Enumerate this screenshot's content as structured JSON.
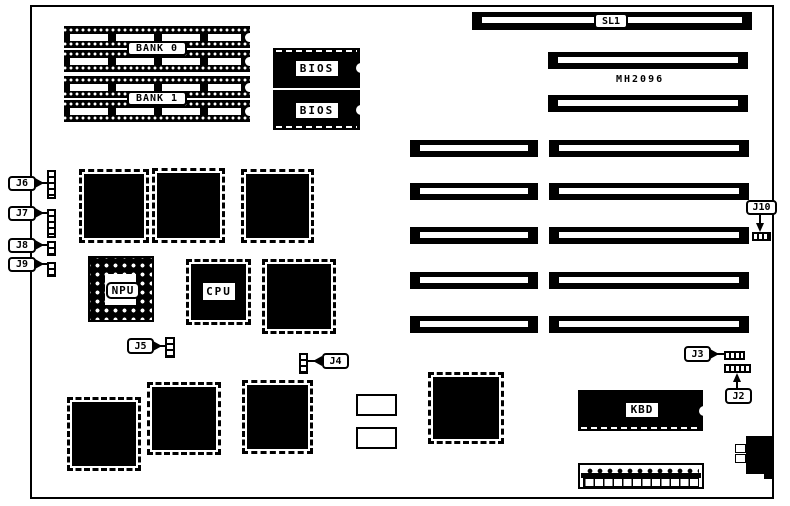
{
  "colors": {
    "ink": "#000000",
    "paper": "#ffffff"
  },
  "memory": {
    "bank_labels": [
      "BANK 0",
      "BANK 1"
    ]
  },
  "bios": {
    "labels": [
      "BIOS",
      "BIOS"
    ]
  },
  "slots": {
    "sl1": "SL1",
    "model_text": "MH2096"
  },
  "processors": {
    "npu": "NPU",
    "cpu": "CPU"
  },
  "keyboard_controller": {
    "label": "KBD"
  },
  "jumpers": {
    "j2": "J2",
    "j3": "J3",
    "j4": "J4",
    "j5": "J5",
    "j6": "J6",
    "j7": "J7",
    "j8": "J8",
    "j9": "J9",
    "j10": "J10"
  }
}
